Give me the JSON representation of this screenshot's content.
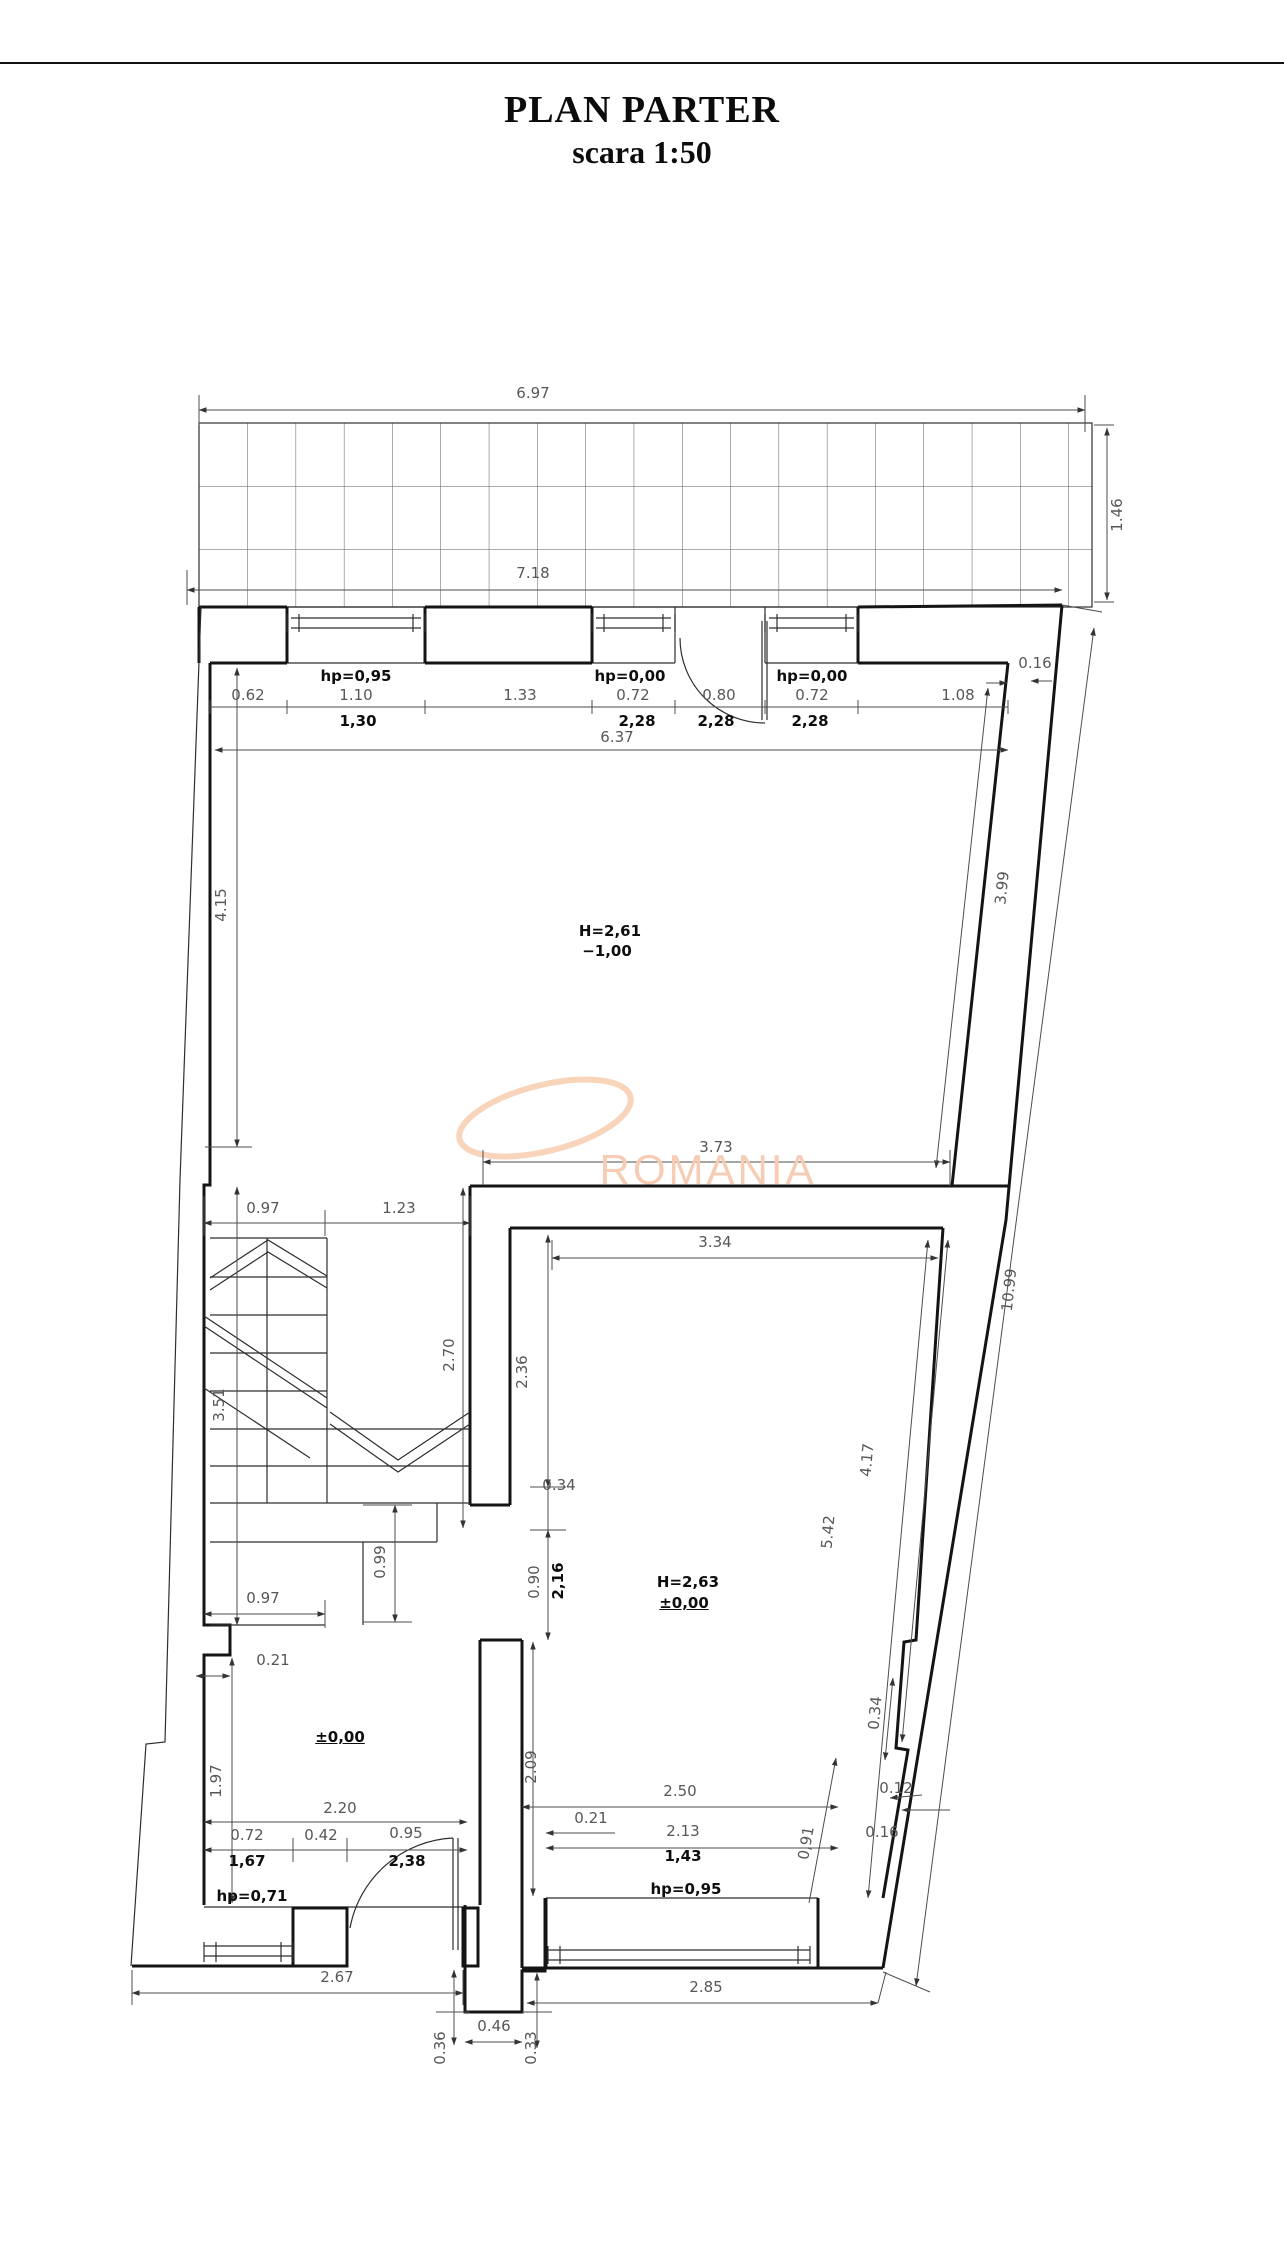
{
  "title": {
    "line1": "PLAN PARTER",
    "line2": "scara 1:50"
  },
  "watermark": {
    "text": "ROMANIA",
    "color": "#f6cdb4"
  },
  "colors": {
    "wall": "#141414",
    "dim_text": "#575757",
    "bold_text": "#0e0e0e",
    "watermark": "#f7cfb4"
  },
  "rooms": [
    {
      "name": "room-basement-level",
      "height_label": "H=2,61",
      "level_label": "−1,00"
    },
    {
      "name": "room-ground-level",
      "height_label": "H=2,63",
      "level_label": "±0,00"
    },
    {
      "name": "entrance-hall",
      "level_label": "±0,00"
    }
  ],
  "labels": [
    {
      "t": "6.97",
      "x": 533,
      "y": 393,
      "k": "dim"
    },
    {
      "t": "7.18",
      "x": 533,
      "y": 573,
      "k": "dim"
    },
    {
      "t": "1.46",
      "x": 1117,
      "y": 515,
      "r": -90,
      "k": "dim"
    },
    {
      "t": "hp=0,95",
      "x": 356,
      "y": 676,
      "k": "sill",
      "b": 1
    },
    {
      "t": "0.62",
      "x": 248,
      "y": 695,
      "k": "dim"
    },
    {
      "t": "1.10",
      "x": 356,
      "y": 695,
      "k": "dim"
    },
    {
      "t": "1,30",
      "x": 358,
      "y": 721,
      "k": "dim",
      "b": 1
    },
    {
      "t": "1.33",
      "x": 520,
      "y": 695,
      "k": "dim"
    },
    {
      "t": "hp=0,00",
      "x": 630,
      "y": 676,
      "k": "sill",
      "b": 1
    },
    {
      "t": "0.72",
      "x": 633,
      "y": 695,
      "k": "dim"
    },
    {
      "t": "0.80",
      "x": 719,
      "y": 695,
      "k": "dim"
    },
    {
      "t": "hp=0,00",
      "x": 812,
      "y": 676,
      "k": "sill",
      "b": 1
    },
    {
      "t": "0.72",
      "x": 812,
      "y": 695,
      "k": "dim"
    },
    {
      "t": "1.08",
      "x": 958,
      "y": 695,
      "k": "dim"
    },
    {
      "t": "0.16",
      "x": 1035,
      "y": 663,
      "k": "dim"
    },
    {
      "t": "2,28",
      "x": 637,
      "y": 721,
      "k": "dim",
      "b": 1
    },
    {
      "t": "2,28",
      "x": 716,
      "y": 721,
      "k": "dim",
      "b": 1
    },
    {
      "t": "2,28",
      "x": 810,
      "y": 721,
      "k": "dim",
      "b": 1
    },
    {
      "t": "6.37",
      "x": 617,
      "y": 737,
      "k": "dim"
    },
    {
      "t": "H=2,61",
      "x": 610,
      "y": 931,
      "k": "room",
      "b": 1
    },
    {
      "t": "−1,00",
      "x": 607,
      "y": 951,
      "k": "level",
      "b": 1
    },
    {
      "t": "4.15",
      "x": 221,
      "y": 905,
      "r": -90,
      "k": "dim"
    },
    {
      "t": "3.99",
      "x": 1002,
      "y": 888,
      "r": -84,
      "k": "dim"
    },
    {
      "t": "10.99",
      "x": 1009,
      "y": 1290,
      "r": -84,
      "k": "dim"
    },
    {
      "t": "3.73",
      "x": 716,
      "y": 1147,
      "k": "dim"
    },
    {
      "t": "0.97",
      "x": 263,
      "y": 1208,
      "k": "dim"
    },
    {
      "t": "1.23",
      "x": 399,
      "y": 1208,
      "k": "dim"
    },
    {
      "t": "3.51",
      "x": 219,
      "y": 1405,
      "r": -90,
      "k": "dim"
    },
    {
      "t": "2.70",
      "x": 449,
      "y": 1355,
      "r": -90,
      "k": "dim"
    },
    {
      "t": "3.34",
      "x": 715,
      "y": 1242,
      "k": "dim"
    },
    {
      "t": "2.36",
      "x": 522,
      "y": 1372,
      "r": -90,
      "k": "dim"
    },
    {
      "t": "0.34",
      "x": 559,
      "y": 1485,
      "k": "dim"
    },
    {
      "t": "0.99",
      "x": 380,
      "y": 1562,
      "r": -90,
      "k": "dim"
    },
    {
      "t": "0.97",
      "x": 263,
      "y": 1598,
      "k": "dim"
    },
    {
      "t": "0.90",
      "x": 534,
      "y": 1582,
      "r": -90,
      "k": "dim"
    },
    {
      "t": "2,16",
      "x": 558,
      "y": 1581,
      "r": -90,
      "k": "dim",
      "b": 1
    },
    {
      "t": "H=2,63",
      "x": 688,
      "y": 1582,
      "k": "room",
      "b": 1
    },
    {
      "t": "±0,00",
      "x": 684,
      "y": 1603,
      "k": "level",
      "b": 1,
      "u": 1
    },
    {
      "t": "5.42",
      "x": 828,
      "y": 1532,
      "r": -85,
      "k": "dim"
    },
    {
      "t": "4.17",
      "x": 867,
      "y": 1460,
      "r": -85,
      "k": "dim"
    },
    {
      "t": "0.34",
      "x": 875,
      "y": 1713,
      "r": -85,
      "k": "dim"
    },
    {
      "t": "0.21",
      "x": 273,
      "y": 1660,
      "k": "dim"
    },
    {
      "t": "±0,00",
      "x": 340,
      "y": 1737,
      "k": "level",
      "b": 1,
      "u": 1
    },
    {
      "t": "1.97",
      "x": 216,
      "y": 1781,
      "r": -90,
      "k": "dim"
    },
    {
      "t": "2.20",
      "x": 340,
      "y": 1808,
      "k": "dim"
    },
    {
      "t": "2.09",
      "x": 531,
      "y": 1767,
      "r": -90,
      "k": "dim"
    },
    {
      "t": "2.50",
      "x": 680,
      "y": 1791,
      "k": "dim"
    },
    {
      "t": "0.21",
      "x": 591,
      "y": 1818,
      "k": "dim"
    },
    {
      "t": "2.13",
      "x": 683,
      "y": 1831,
      "k": "dim"
    },
    {
      "t": "1,43",
      "x": 683,
      "y": 1856,
      "k": "dim",
      "b": 1
    },
    {
      "t": "0,91",
      "x": 806,
      "y": 1843,
      "r": -80,
      "k": "dim"
    },
    {
      "t": "0.12",
      "x": 896,
      "y": 1788,
      "k": "dim"
    },
    {
      "t": "0.16",
      "x": 882,
      "y": 1832,
      "k": "dim"
    },
    {
      "t": "0.72",
      "x": 247,
      "y": 1835,
      "k": "dim"
    },
    {
      "t": "0.42",
      "x": 321,
      "y": 1835,
      "k": "dim"
    },
    {
      "t": "0.95",
      "x": 406,
      "y": 1833,
      "k": "dim"
    },
    {
      "t": "1,67",
      "x": 247,
      "y": 1861,
      "k": "dim",
      "b": 1
    },
    {
      "t": "2,38",
      "x": 407,
      "y": 1861,
      "k": "dim",
      "b": 1
    },
    {
      "t": "hp=0,71",
      "x": 252,
      "y": 1896,
      "k": "sill",
      "b": 1
    },
    {
      "t": "hp=0,95",
      "x": 686,
      "y": 1889,
      "k": "sill",
      "b": 1
    },
    {
      "t": "2.67",
      "x": 337,
      "y": 1977,
      "k": "dim"
    },
    {
      "t": "2.85",
      "x": 706,
      "y": 1987,
      "k": "dim"
    },
    {
      "t": "0.46",
      "x": 494,
      "y": 2026,
      "k": "dim"
    },
    {
      "t": "0.36",
      "x": 440,
      "y": 2048,
      "r": -90,
      "k": "dim"
    },
    {
      "t": "0.33",
      "x": 531,
      "y": 2048,
      "r": -90,
      "k": "dim"
    }
  ]
}
